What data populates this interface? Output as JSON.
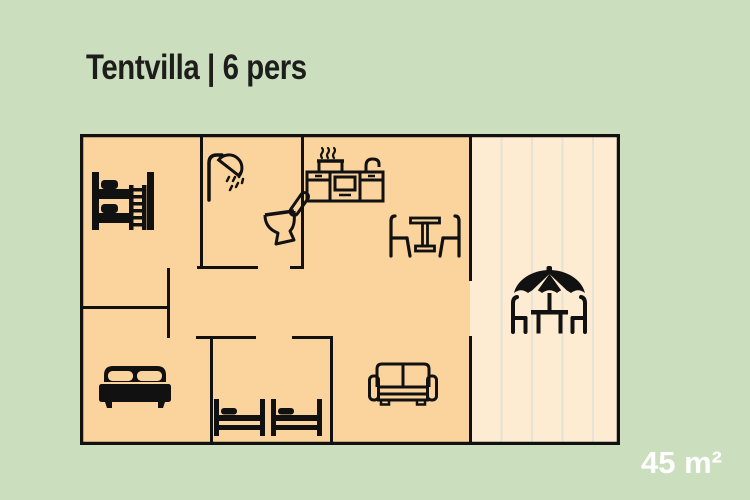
{
  "title": "Tentvilla | 6 pers",
  "area_label": "45 m²",
  "floorplan": {
    "icons": [
      "bunk-bed-icon",
      "shower-icon",
      "toilet-icon",
      "kitchen-icon",
      "dining-table-icon",
      "sofa-icon",
      "double-bed-icon",
      "single-beds-icon",
      "umbrella-table-icon"
    ]
  },
  "colors": {
    "background": "#cbdfbe",
    "floor": "#fbd49d",
    "terrace": "#fdecd2",
    "terrace_stripe": "#e8e2d6",
    "walls_and_icons": "#111111",
    "title_text": "#1d1d1b",
    "area_text": "#ffffff"
  }
}
